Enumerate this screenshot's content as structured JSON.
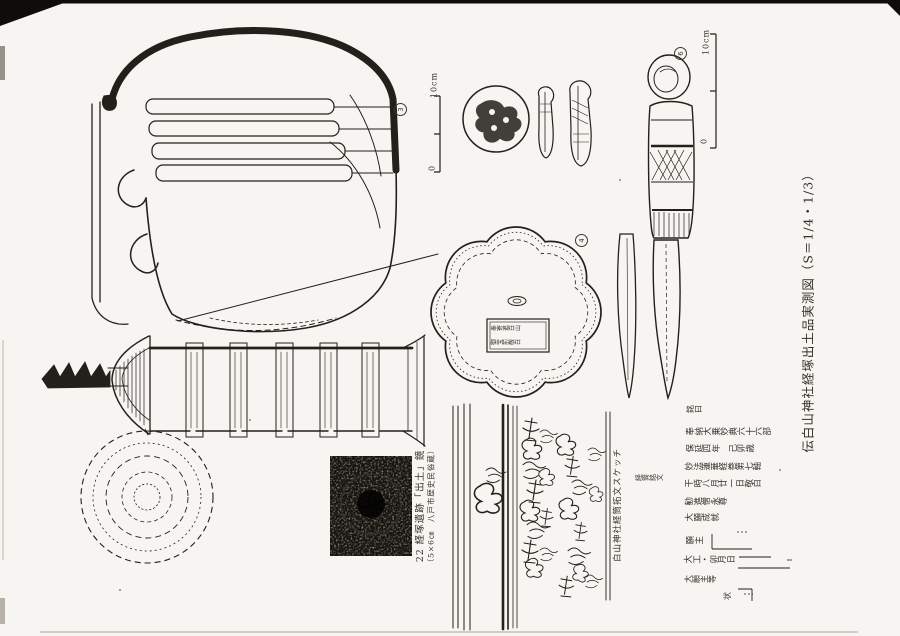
{
  "page": {
    "caption": "伝白山神社経塚出土品実測図（S＝1/4・1/3）"
  },
  "scales": {
    "jar_top": "10cm",
    "jar_zero": "0",
    "knife_top": "10cm",
    "knife_zero": "0"
  },
  "item_numbers": {
    "jar": "3",
    "mirror": "4",
    "knife": "6"
  },
  "mirror": {
    "cartouche_line1": "奉寄進白山",
    "cartouche_line2": "御宝前敬白"
  },
  "photo": {
    "caption_line1": "22 経塚遺跡「出土」鏡",
    "caption_line2": "（5×6㎝　八戸市歴史民俗蔵）"
  },
  "sketch": {
    "caption": "白山神社経筒拓文スケッチ",
    "label": "経筒銘文"
  },
  "transcription": {
    "rows": [
      "銘曰",
      "奉納大乗妙典六十六部",
      "保延四年　己卯歳",
      "妙法蓮華経巻第七軸",
      "干時八月廿一日敬白",
      "勧進僧永尊",
      "大願成就",
      "願主",
      "大工・卯月日",
      "大願主等",
      "状"
    ]
  }
}
